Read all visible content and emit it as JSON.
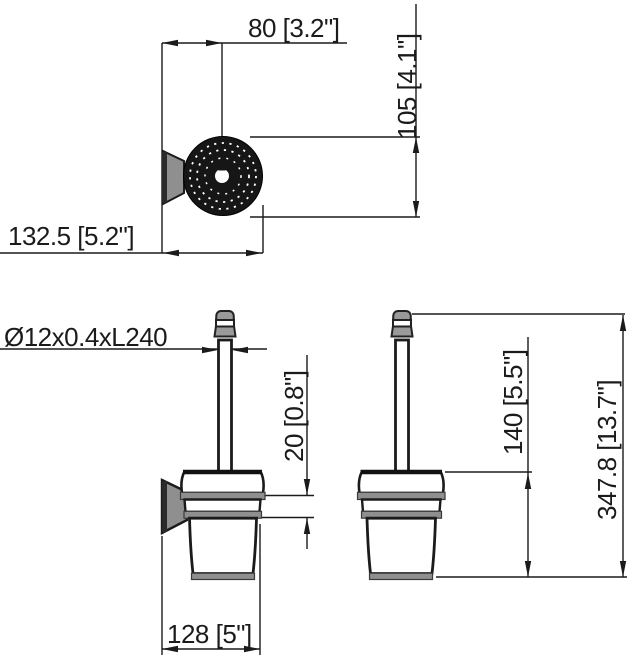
{
  "dims": {
    "top_width": "80 [3.2\"]",
    "top_height": "105 [4.1\"]",
    "wall_depth": "132.5 [5.2\"]",
    "brush_spec": "Ø12x0.4xL240",
    "collar_height": "20 [0.8\"]",
    "cup_height": "140 [5.5\"]",
    "total_height": "347.8 [13.7\"]",
    "base_width": "128 [5\"]"
  },
  "colors": {
    "line": "#1b1b1b",
    "gray": "#8f8f8f",
    "flange": "#161616",
    "background": "#ffffff"
  }
}
